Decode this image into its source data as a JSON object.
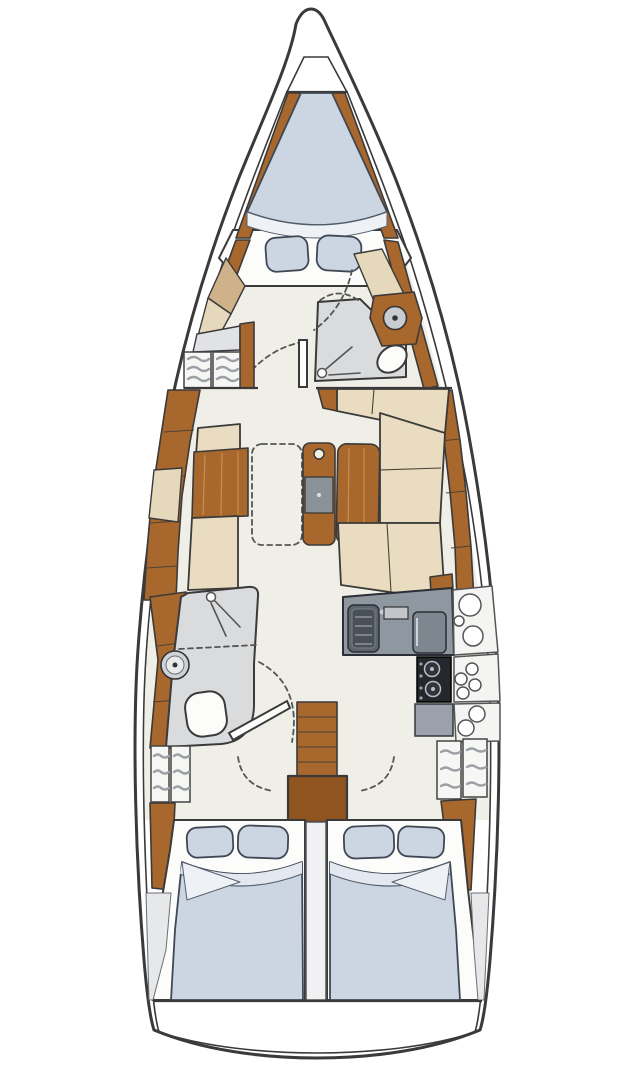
{
  "meta": {
    "kind": "sailboat-interior-floor-plan",
    "views": "top-down"
  },
  "colors": {
    "outline": "#3a3a3a",
    "hull": "#ffffff",
    "floor": "#f0efe7",
    "wood": "#a8672c",
    "woodDark": "#8f541f",
    "woodLight": "#cf9a55",
    "tan": "#cfb28a",
    "tanLight": "#e6d8ba",
    "cream": "#e9dcc0",
    "mattress": "#ccd6e2",
    "mattressLight": "#e3e8f1",
    "sheetFold": "#eef1f6",
    "grayRoom": "#d9dbdd",
    "deckGray": "#e6e8ea",
    "counter": "#8f97a1",
    "applianceDark": "#5d646e",
    "fridgeGray": "#7e868f",
    "stoveBlack": "#24272c",
    "blockGray": "#9ba2ab",
    "panel": "#f4f4f2",
    "whiteFixture": "#fcfcfb",
    "lockerFace": "#f6f6f5",
    "lockerStripe": "#9aa0a6",
    "dividerFill": "#f0f1f2"
  },
  "icons": {
    "sink": "circle-with-center-dot",
    "toilet": "rounded-oval",
    "shower": "spray-head-with-lines",
    "stove": "two-burner-circles",
    "fridge": "lidded-square",
    "steps": "ladder-treads",
    "door_swing": "dashed-quarter-arc",
    "hatch_storage": "round-openings",
    "locker": "slatted-vents"
  }
}
